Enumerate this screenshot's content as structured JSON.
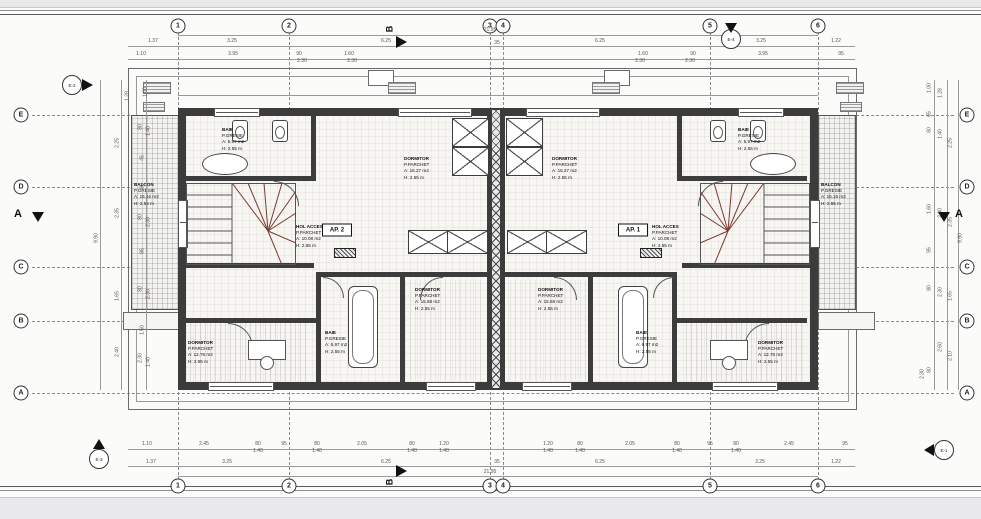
{
  "grid": {
    "columns": [
      {
        "label": "1",
        "x": 178
      },
      {
        "label": "2",
        "x": 289
      },
      {
        "label": "3",
        "x": 490
      },
      {
        "label": "4",
        "x": 503
      },
      {
        "label": "5",
        "x": 710
      },
      {
        "label": "6",
        "x": 818
      }
    ],
    "rows": [
      {
        "label": "E",
        "y": 115
      },
      {
        "label": "D",
        "y": 187
      },
      {
        "label": "C",
        "y": 267
      },
      {
        "label": "B",
        "y": 321
      },
      {
        "label": "A",
        "y": 393
      }
    ]
  },
  "section_marks": {
    "horizontal": "B",
    "vertical": "A"
  },
  "elevation_marks": [
    {
      "label": "E-2",
      "x": 72,
      "y": 85,
      "dir": "right"
    },
    {
      "label": "E-4",
      "x": 731,
      "y": 39,
      "dir": "down"
    },
    {
      "label": "E-3",
      "x": 99,
      "y": 459,
      "dir": "up"
    },
    {
      "label": "E-1",
      "x": 944,
      "y": 450,
      "dir": "left"
    }
  ],
  "apartment_tags": [
    {
      "t": "AP. 2",
      "x": 337,
      "y": 230
    },
    {
      "t": "AP. 1",
      "x": 633,
      "y": 230
    }
  ],
  "rooms": [
    {
      "l1": "BAIE",
      "l2": "P.GRESIE",
      "l3": "A: 5.97 m2",
      "l4": "H: 2.55 m",
      "x": 222,
      "y": 127
    },
    {
      "l1": "DORMITOR",
      "l2": "P.PARCHET",
      "l3": "A: 16.27 m2",
      "l4": "H: 2.55 m",
      "x": 404,
      "y": 156
    },
    {
      "l1": "HOL ACCES",
      "l2": "P.PARCHET",
      "l3": "A: 10.08 m2",
      "l4": "H: 2.55 m",
      "x": 296,
      "y": 224
    },
    {
      "l1": "BALCON",
      "l2": "P.GRESIE",
      "l3": "A: 15.16 m2",
      "l4": "H: 2.55 m",
      "x": 134,
      "y": 182
    },
    {
      "l1": "DORMITOR",
      "l2": "P.PARCHET",
      "l3": "A: 15.68 m2",
      "l4": "H: 2.55 m",
      "x": 415,
      "y": 287
    },
    {
      "l1": "BAIE",
      "l2": "P.GRESIE",
      "l3": "A: 6.97 m2",
      "l4": "H: 2.55 m",
      "x": 325,
      "y": 330
    },
    {
      "l1": "DORMITOR",
      "l2": "P.PARCHET",
      "l3": "A: 12.76 m2",
      "l4": "H: 2.55 m",
      "x": 188,
      "y": 340
    },
    {
      "l1": "BAIE",
      "l2": "P.GRESIE",
      "l3": "A: 5.97 m2",
      "l4": "H: 2.55 m",
      "x": 738,
      "y": 127
    },
    {
      "l1": "DORMITOR",
      "l2": "P.PARCHET",
      "l3": "A: 16.27 m2",
      "l4": "H: 2.55 m",
      "x": 552,
      "y": 156
    },
    {
      "l1": "HOL ACCES",
      "l2": "P.PARCHET",
      "l3": "A: 10.08 m2",
      "l4": "H: 2.55 m",
      "x": 652,
      "y": 224
    },
    {
      "l1": "BALCON",
      "l2": "P.GRESIE",
      "l3": "A: 15.16 m2",
      "l4": "H: 2.55 m",
      "x": 821,
      "y": 182
    },
    {
      "l1": "DORMITOR",
      "l2": "P.PARCHET",
      "l3": "A: 15.68 m2",
      "l4": "H: 2.55 m",
      "x": 538,
      "y": 287
    },
    {
      "l1": "BAIE",
      "l2": "P.GRESIE",
      "l3": "A: 6.97 m2",
      "l4": "H: 2.55 m",
      "x": 636,
      "y": 330
    },
    {
      "l1": "DORMITOR",
      "l2": "P.PARCHET",
      "l3": "A: 12.76 m2",
      "l4": "H: 2.55 m",
      "x": 758,
      "y": 340
    }
  ],
  "dims_h": [
    {
      "t": "21.95",
      "x": 490,
      "y": 28
    },
    {
      "t": "1.37",
      "x": 153,
      "y": 39
    },
    {
      "t": "3.25",
      "x": 232,
      "y": 39
    },
    {
      "t": "6.25",
      "x": 386,
      "y": 39
    },
    {
      "t": "35",
      "x": 497,
      "y": 41
    },
    {
      "t": "6.25",
      "x": 600,
      "y": 39
    },
    {
      "t": "3.25",
      "x": 761,
      "y": 39
    },
    {
      "t": "1.22",
      "x": 836,
      "y": 39
    },
    {
      "t": "1.10",
      "x": 141,
      "y": 52
    },
    {
      "t": "3.95",
      "x": 233,
      "y": 52
    },
    {
      "t": "90",
      "x": 299,
      "y": 52
    },
    {
      "t": "2.30",
      "x": 302,
      "y": 59
    },
    {
      "t": "1.60",
      "x": 349,
      "y": 52
    },
    {
      "t": "2.30",
      "x": 352,
      "y": 59
    },
    {
      "t": "1.60",
      "x": 643,
      "y": 52
    },
    {
      "t": "2.30",
      "x": 640,
      "y": 59
    },
    {
      "t": "90",
      "x": 693,
      "y": 52
    },
    {
      "t": "2.30",
      "x": 690,
      "y": 59
    },
    {
      "t": "3.95",
      "x": 763,
      "y": 52
    },
    {
      "t": "95",
      "x": 841,
      "y": 52
    },
    {
      "t": "1.10",
      "x": 147,
      "y": 442
    },
    {
      "t": "2.45",
      "x": 204,
      "y": 442
    },
    {
      "t": "80",
      "x": 258,
      "y": 442
    },
    {
      "t": "1.40",
      "x": 258,
      "y": 449
    },
    {
      "t": "95",
      "x": 284,
      "y": 442
    },
    {
      "t": "80",
      "x": 317,
      "y": 442
    },
    {
      "t": "1.40",
      "x": 317,
      "y": 449
    },
    {
      "t": "2.05",
      "x": 362,
      "y": 442
    },
    {
      "t": "80",
      "x": 412,
      "y": 442
    },
    {
      "t": "1.40",
      "x": 412,
      "y": 449
    },
    {
      "t": "1.20",
      "x": 444,
      "y": 442
    },
    {
      "t": "1.40",
      "x": 444,
      "y": 449
    },
    {
      "t": "1.20",
      "x": 548,
      "y": 442
    },
    {
      "t": "1.40",
      "x": 548,
      "y": 449
    },
    {
      "t": "80",
      "x": 580,
      "y": 442
    },
    {
      "t": "1.40",
      "x": 580,
      "y": 449
    },
    {
      "t": "2.05",
      "x": 630,
      "y": 442
    },
    {
      "t": "80",
      "x": 677,
      "y": 442
    },
    {
      "t": "1.40",
      "x": 677,
      "y": 449
    },
    {
      "t": "95",
      "x": 710,
      "y": 442
    },
    {
      "t": "80",
      "x": 736,
      "y": 442
    },
    {
      "t": "1.40",
      "x": 736,
      "y": 449
    },
    {
      "t": "2.45",
      "x": 789,
      "y": 442
    },
    {
      "t": "95",
      "x": 845,
      "y": 442
    },
    {
      "t": "1.37",
      "x": 151,
      "y": 460
    },
    {
      "t": "3.25",
      "x": 227,
      "y": 460
    },
    {
      "t": "6.25",
      "x": 386,
      "y": 460
    },
    {
      "t": "35",
      "x": 497,
      "y": 460
    },
    {
      "t": "6.25",
      "x": 600,
      "y": 460
    },
    {
      "t": "3.25",
      "x": 760,
      "y": 460
    },
    {
      "t": "1.22",
      "x": 836,
      "y": 460
    },
    {
      "t": "21.95",
      "x": 490,
      "y": 470
    }
  ],
  "dims_v": [
    {
      "t": "9.90",
      "x": 97,
      "y": 238
    },
    {
      "t": "2.25",
      "x": 118,
      "y": 143
    },
    {
      "t": "2.35",
      "x": 118,
      "y": 213
    },
    {
      "t": "1.65",
      "x": 118,
      "y": 296
    },
    {
      "t": "2.40",
      "x": 118,
      "y": 352
    },
    {
      "t": "1.28",
      "x": 128,
      "y": 96
    },
    {
      "t": "1.00",
      "x": 146,
      "y": 92
    },
    {
      "t": "80",
      "x": 141,
      "y": 127
    },
    {
      "t": "1.40",
      "x": 149,
      "y": 131
    },
    {
      "t": "45",
      "x": 143,
      "y": 158
    },
    {
      "t": "95",
      "x": 143,
      "y": 186
    },
    {
      "t": "80",
      "x": 141,
      "y": 217
    },
    {
      "t": "2.30",
      "x": 149,
      "y": 222
    },
    {
      "t": "95",
      "x": 143,
      "y": 251
    },
    {
      "t": "80",
      "x": 141,
      "y": 289
    },
    {
      "t": "2.30",
      "x": 149,
      "y": 294
    },
    {
      "t": "1.50",
      "x": 143,
      "y": 330
    },
    {
      "t": "2.30",
      "x": 141,
      "y": 358
    },
    {
      "t": "1.40",
      "x": 149,
      "y": 362
    },
    {
      "t": "9.90",
      "x": 961,
      "y": 238
    },
    {
      "t": "1.00",
      "x": 930,
      "y": 88
    },
    {
      "t": "1.28",
      "x": 941,
      "y": 93
    },
    {
      "t": "65",
      "x": 930,
      "y": 114
    },
    {
      "t": "80",
      "x": 930,
      "y": 130
    },
    {
      "t": "1.40",
      "x": 941,
      "y": 134
    },
    {
      "t": "2.25",
      "x": 951,
      "y": 143
    },
    {
      "t": "1.60",
      "x": 930,
      "y": 209
    },
    {
      "t": "2.30",
      "x": 941,
      "y": 213
    },
    {
      "t": "2.35",
      "x": 951,
      "y": 222
    },
    {
      "t": "95",
      "x": 930,
      "y": 250
    },
    {
      "t": "80",
      "x": 930,
      "y": 288
    },
    {
      "t": "2.30",
      "x": 941,
      "y": 292
    },
    {
      "t": "1.65",
      "x": 951,
      "y": 296
    },
    {
      "t": "2.60",
      "x": 941,
      "y": 347
    },
    {
      "t": "2.10",
      "x": 951,
      "y": 356
    },
    {
      "t": "80",
      "x": 930,
      "y": 370
    },
    {
      "t": "2.30",
      "x": 923,
      "y": 374
    }
  ]
}
